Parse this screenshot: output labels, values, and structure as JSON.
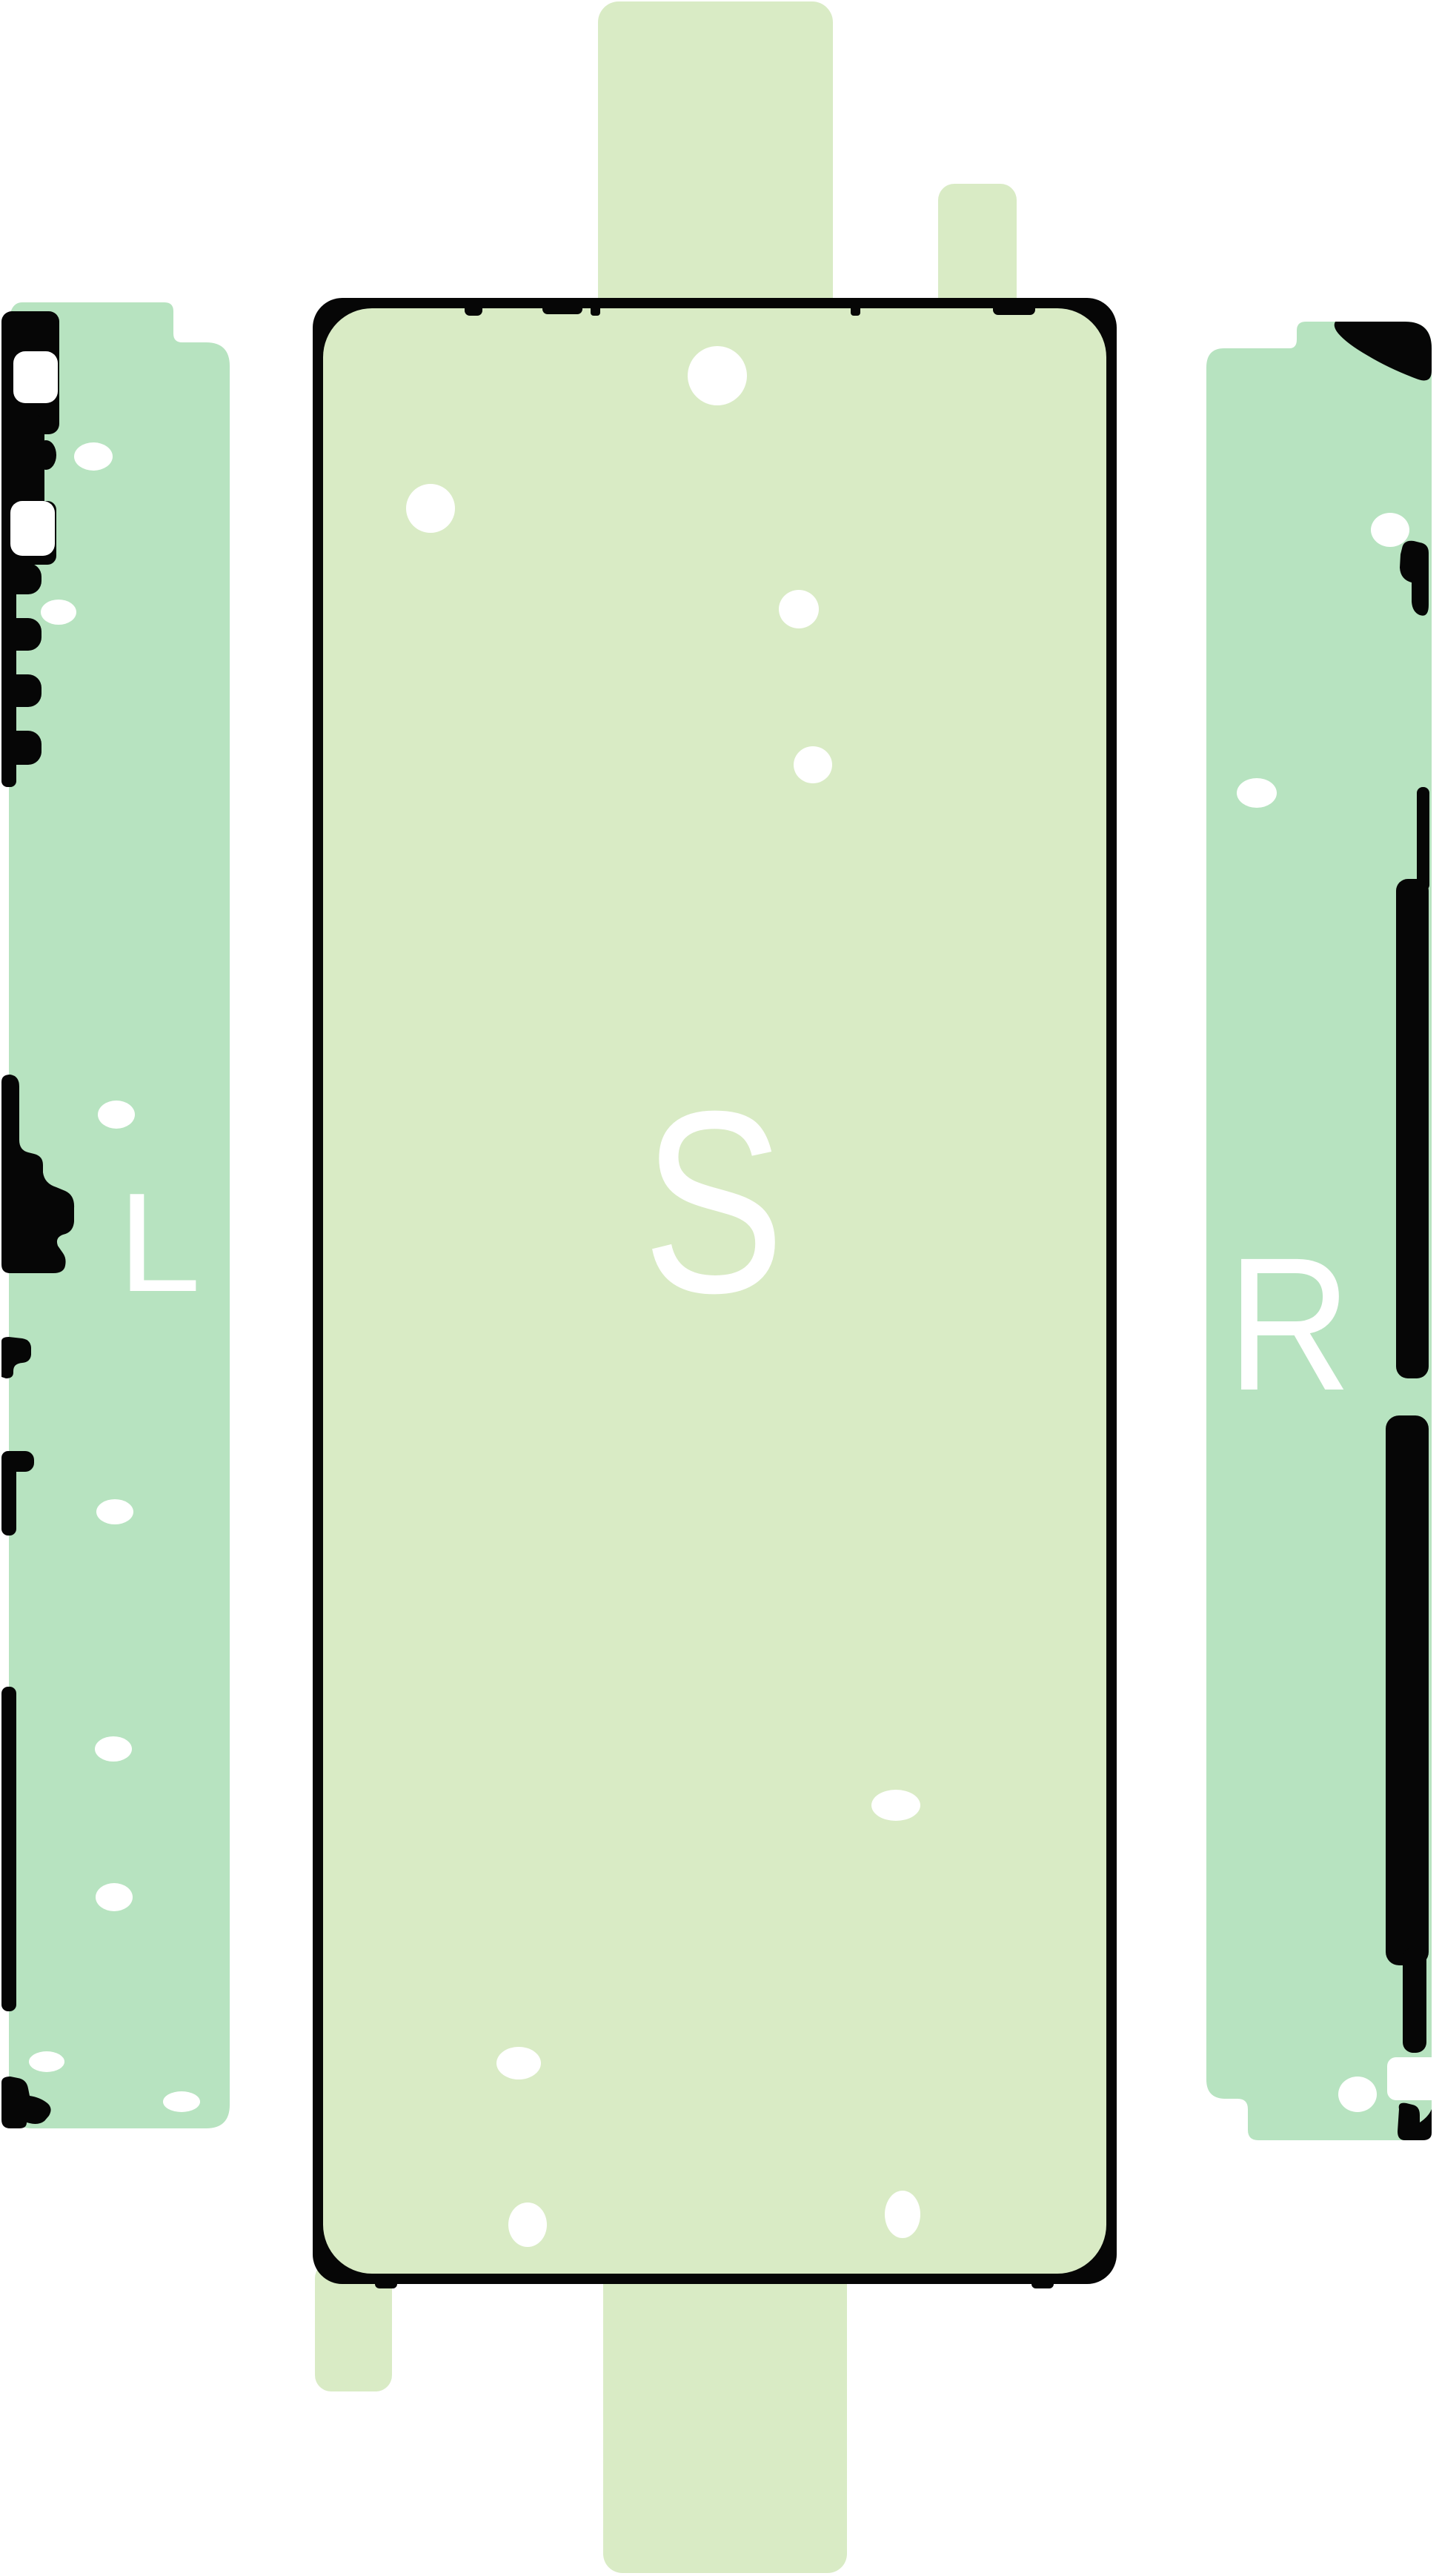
{
  "labels": {
    "left_strip": "L",
    "center_sheet": "S",
    "right_strip": "R"
  },
  "colors": {
    "background": "#ffffff",
    "sheet_light": "#d9ebc5",
    "sheet_mint": "#b7e3c0",
    "ink": "#060606",
    "hole": "#ffffff",
    "letter": "#ffffff"
  }
}
